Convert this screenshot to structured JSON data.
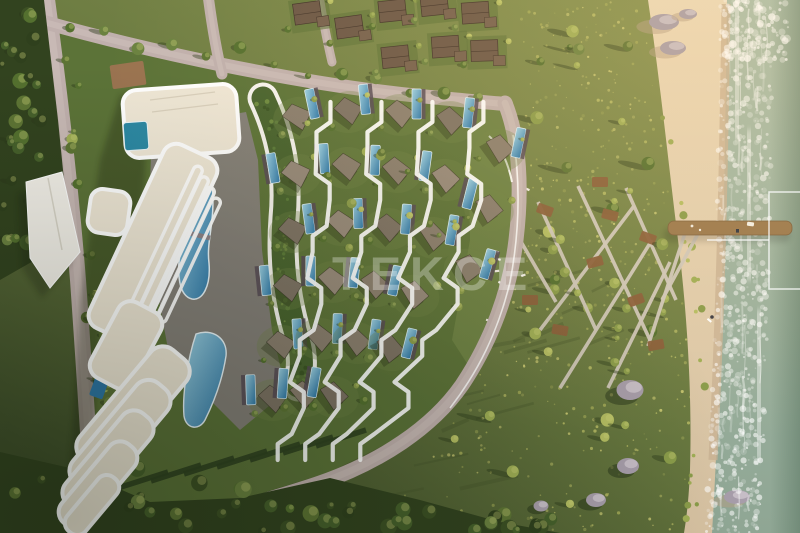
{
  "scene": {
    "type": "aerial-architectural-render",
    "description": "Bird's-eye dusk render of a seafront resort: curved white apartment block with lagoon pool, green-roof garden wing, fan of villa plots with private pools separated by white zig-zag paths, perimeter road, wildflower meadow with zig-zag boardwalks and rocks, sandy beach, surf and a wooden pier",
    "elements": {
      "apartment_building": "curved white terraced apartment block",
      "main_pool": "lagoon-style swimming pool",
      "lower_pool": "secondary curved pool",
      "green_roof": "curved green-roof garden building",
      "villas": "villa plots with private pools",
      "zigzag_paths": "white stepped walkways between villa rows",
      "perimeter_road": "curved boundary road with white guardrail",
      "existing_houses": "neighbouring dark-roof houses along top road",
      "meadow": "wildflower meadow with scattered trees and rocks",
      "boardwalk": "criss-cross boardwalk with timber decks",
      "beach": "sandy beach with rocks",
      "pier": "wooden pier over the surf",
      "sea": "sea with breaking white foam",
      "canopy": "white entrance canopy by the access road"
    }
  },
  "watermark": {
    "logo_text": "TEKCE",
    "frame_note": "partial thin white rectangle outline at right edge"
  },
  "palette": {
    "fieldLight": "#86924f",
    "fieldMid": "#67773f",
    "fieldDark": "#3f4f2a",
    "parcelLawn": "#5c7338",
    "lawnBright": "#6f8445",
    "forest": "#32431f",
    "road": "#c0b0ad",
    "roadLight": "#cfc1bd",
    "white": "#ffffff",
    "cream": "#efe7d6",
    "deck": "#8d8286",
    "poolLight": "#9ed2e4",
    "poolDark": "#2d77a8",
    "poolTeal": "#2c89a4",
    "greenRoof": "#48632e",
    "villaRoof": "#887d6d",
    "villaRoofDark": "#554c3f",
    "poolDeckDark": "#564a55",
    "sea1": "#abbfab",
    "sea2": "#8fa694",
    "seaDeep": "#3c5a46",
    "sand1": "#ecdaba",
    "sand2": "#d6c1a1",
    "sandWet": "#c9b294",
    "pier": "#9a784c",
    "boardwalk": "#d0c8bb",
    "deckBrown": "#8a5f3a",
    "rock": "#a79daa",
    "rockLight": "#cbc3cb",
    "houseRoof": "#6b5746",
    "houseRoof2": "#75604d",
    "hedge": "#2f4220",
    "watermark": "rgba(255,255,255,0.30)",
    "watermarkLine": "rgba(255,255,255,0.78)"
  }
}
